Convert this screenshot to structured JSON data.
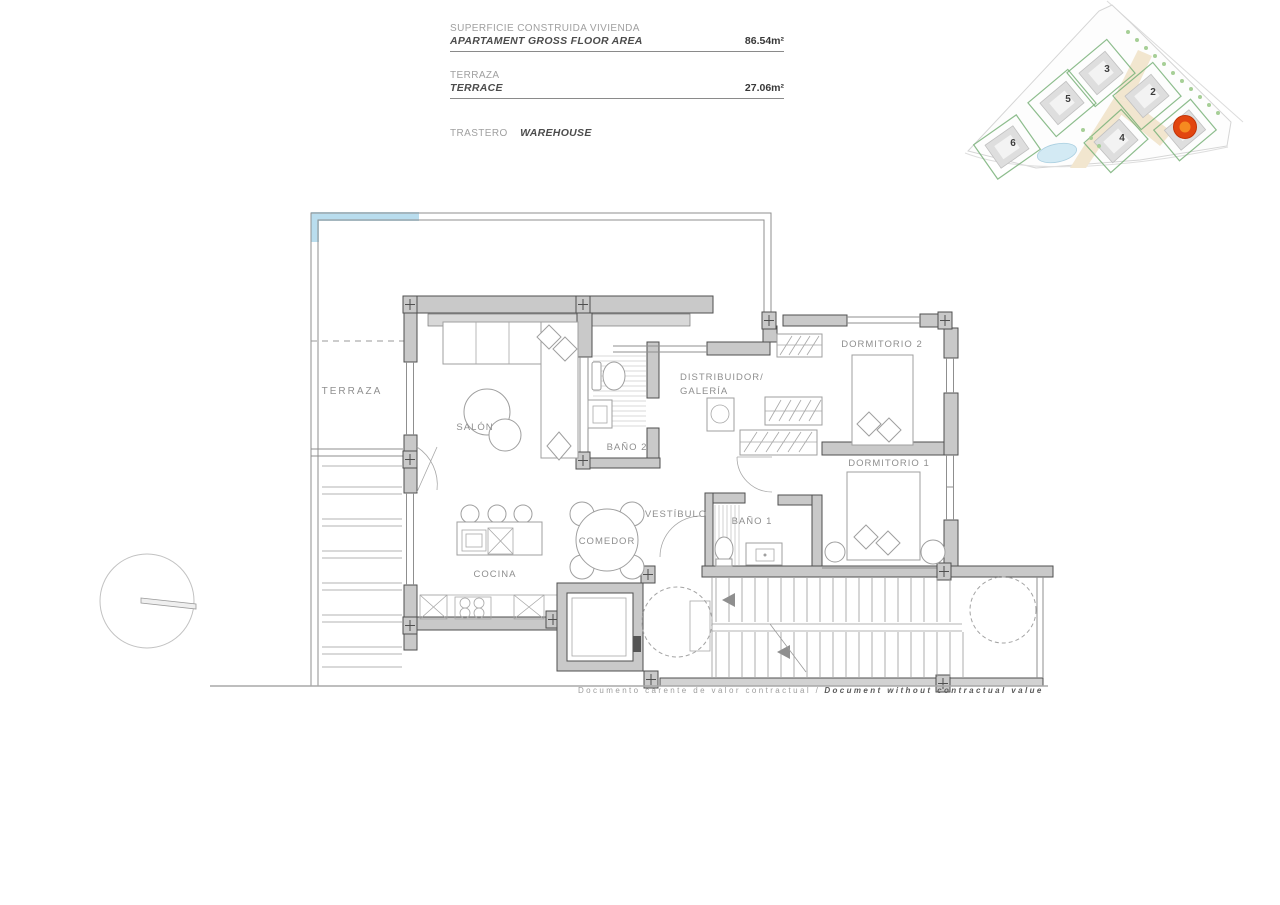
{
  "header": {
    "area_block": {
      "label_es": "SUPERFICIE CONSTRUIDA VIVIENDA",
      "label_en": "APARTAMENT GROSS FLOOR AREA",
      "value": "86.54m²"
    },
    "terrace_block": {
      "label_es": "TERRAZA",
      "label_en": "TERRACE",
      "value": "27.06m²"
    },
    "storage_block": {
      "label_es": "TRASTERO",
      "label_en": "WAREHOUSE"
    }
  },
  "site_plan": {
    "building_numbers": {
      "b2": "2",
      "b3": "3",
      "b4": "4",
      "b5": "5",
      "b6": "6"
    }
  },
  "floor_plan": {
    "labels": {
      "terraza": "TERRAZA",
      "salon": "SALÓN",
      "bano2": "BAÑO 2",
      "distribuidor_1": "DISTRIBUIDOR/",
      "distribuidor_2": "GALERÍA",
      "dormitorio2": "DORMITORIO 2",
      "dormitorio1": "DORMITORIO 1",
      "vestibulo": "VESTÍBULO",
      "bano1": "BAÑO 1",
      "cocina": "COCINA",
      "comedor": "COMEDOR"
    }
  },
  "footer": {
    "disclaimer_es": "Documento carente de valor contractual /",
    "disclaimer_en": "Document without contractual value"
  },
  "colors": {
    "wall": "#c9c9c9",
    "outline": "#4f4f4f",
    "terrace_glass": "#b9ddee",
    "site_road": "#f2e6cf",
    "site_green": "#79b279",
    "pool": "#d3eaf4",
    "marker_outer": "#e2450f",
    "marker_inner": "#f68a20"
  }
}
